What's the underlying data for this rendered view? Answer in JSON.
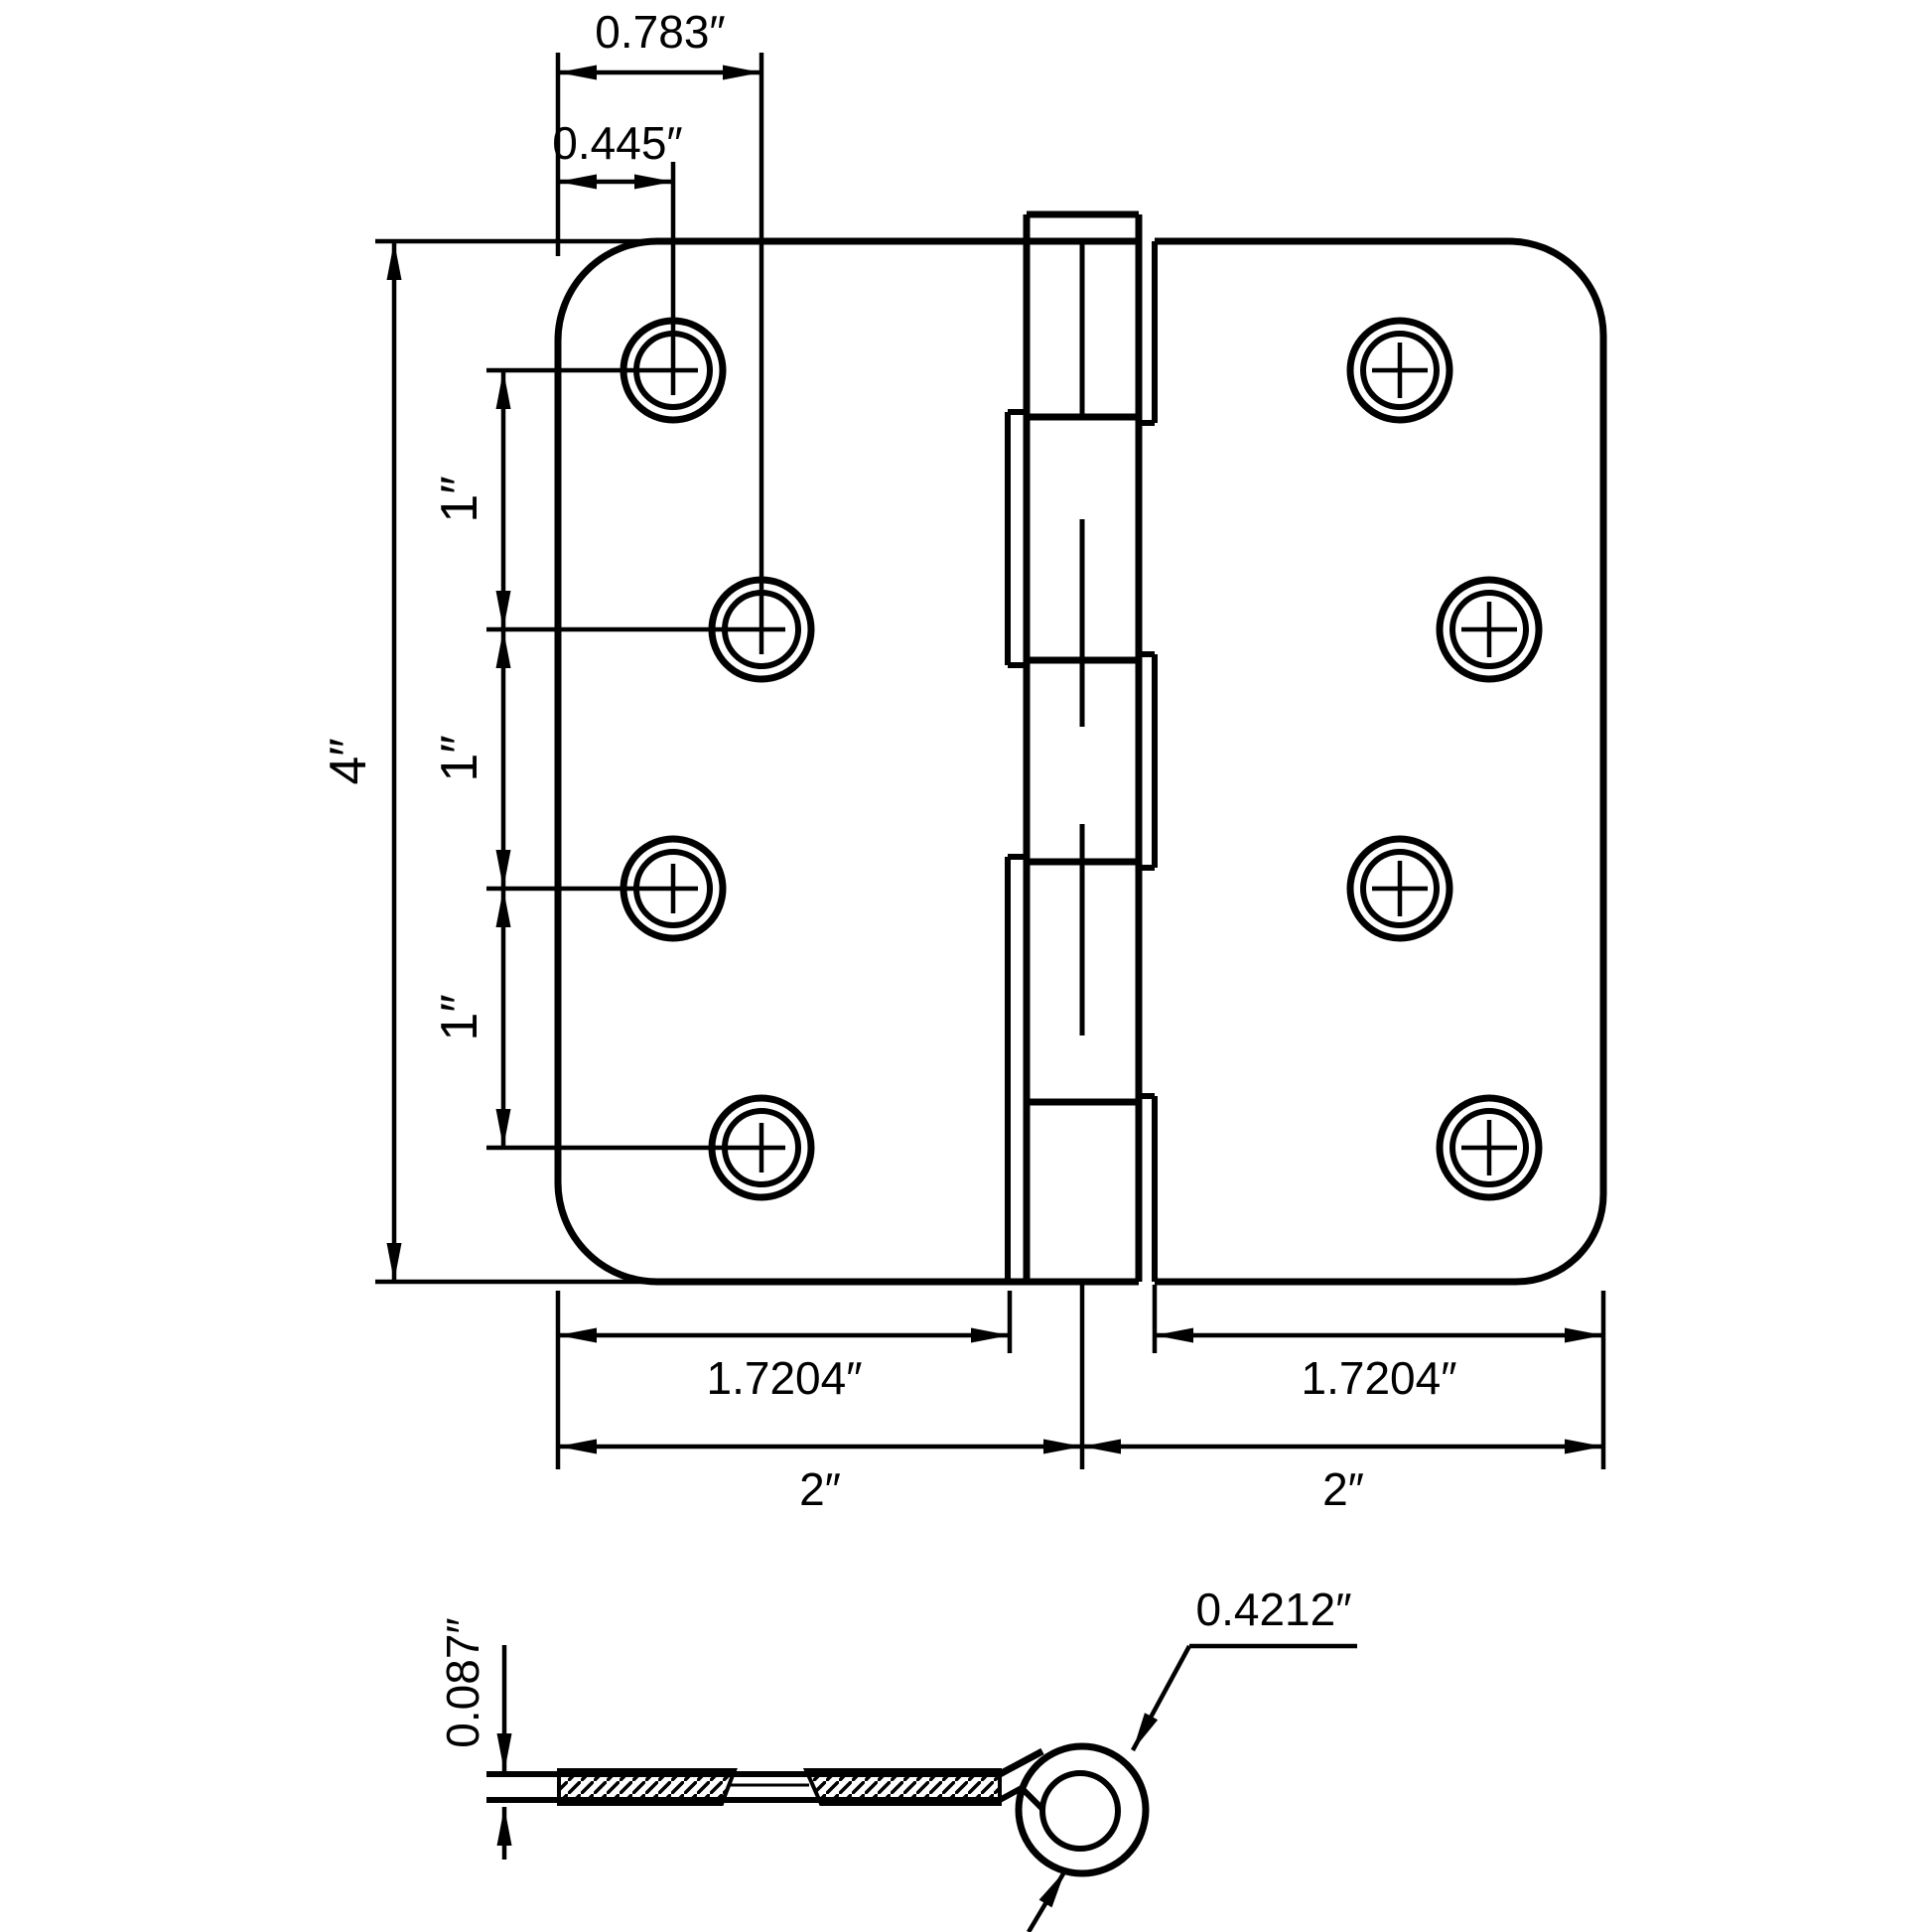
{
  "drawing": {
    "kind": "technical-drawing",
    "subject": "4 inch door hinge - front view and edge section view",
    "line_color": "#000000",
    "background_color": "#ffffff",
    "front_view": {
      "hole_column_far_offset": "0.783″",
      "hole_column_near_offset": "0.445″",
      "overall_height": "4″",
      "hole_pitch": "1″",
      "leaf_width": "1.7204″",
      "half_width": "2″"
    },
    "section_view": {
      "leaf_thickness": "0.087″",
      "knuckle_diameter": "0.4212″"
    }
  }
}
